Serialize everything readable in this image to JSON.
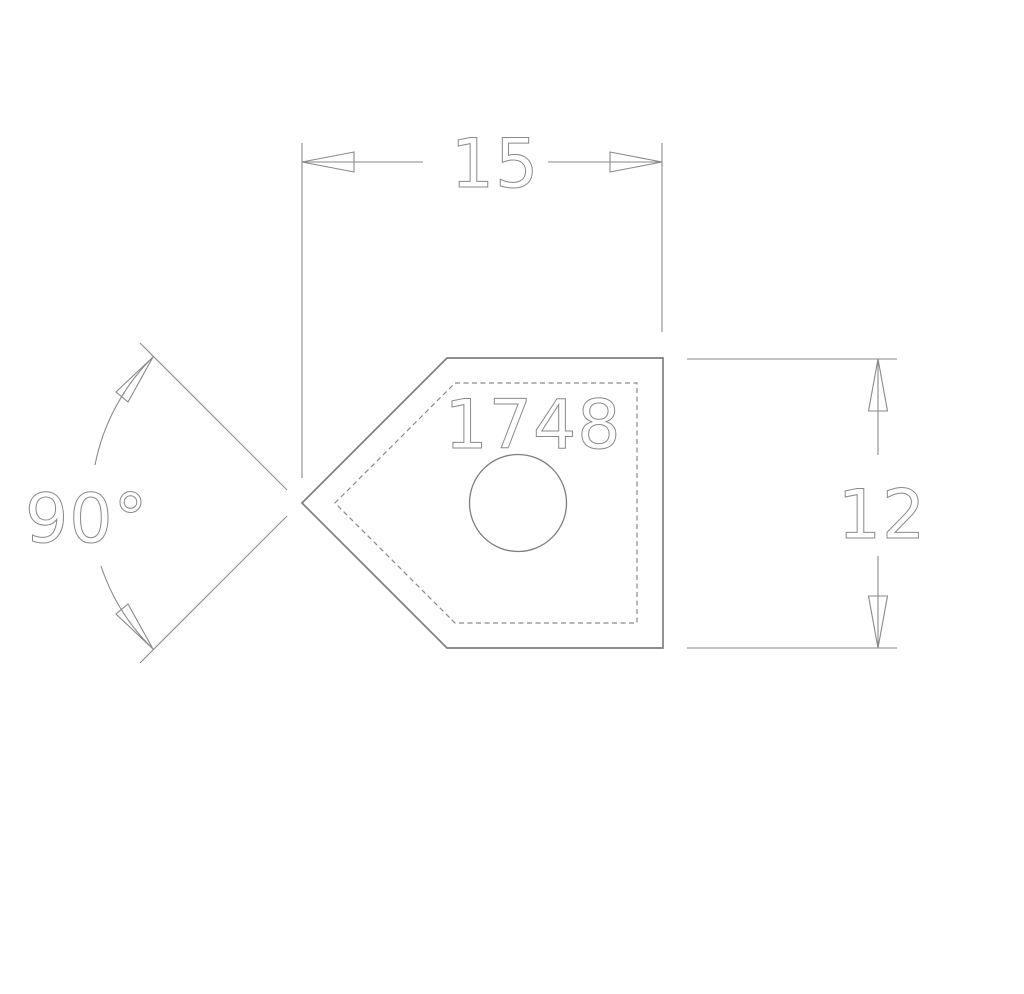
{
  "drawing": {
    "part": {
      "number": "1748"
    },
    "dimensions": {
      "width": "15",
      "height": "12",
      "angle": "90°"
    },
    "colors": {
      "line": "#7f7f7f",
      "dim": "#8a8a8a",
      "background": "#ffffff"
    }
  }
}
